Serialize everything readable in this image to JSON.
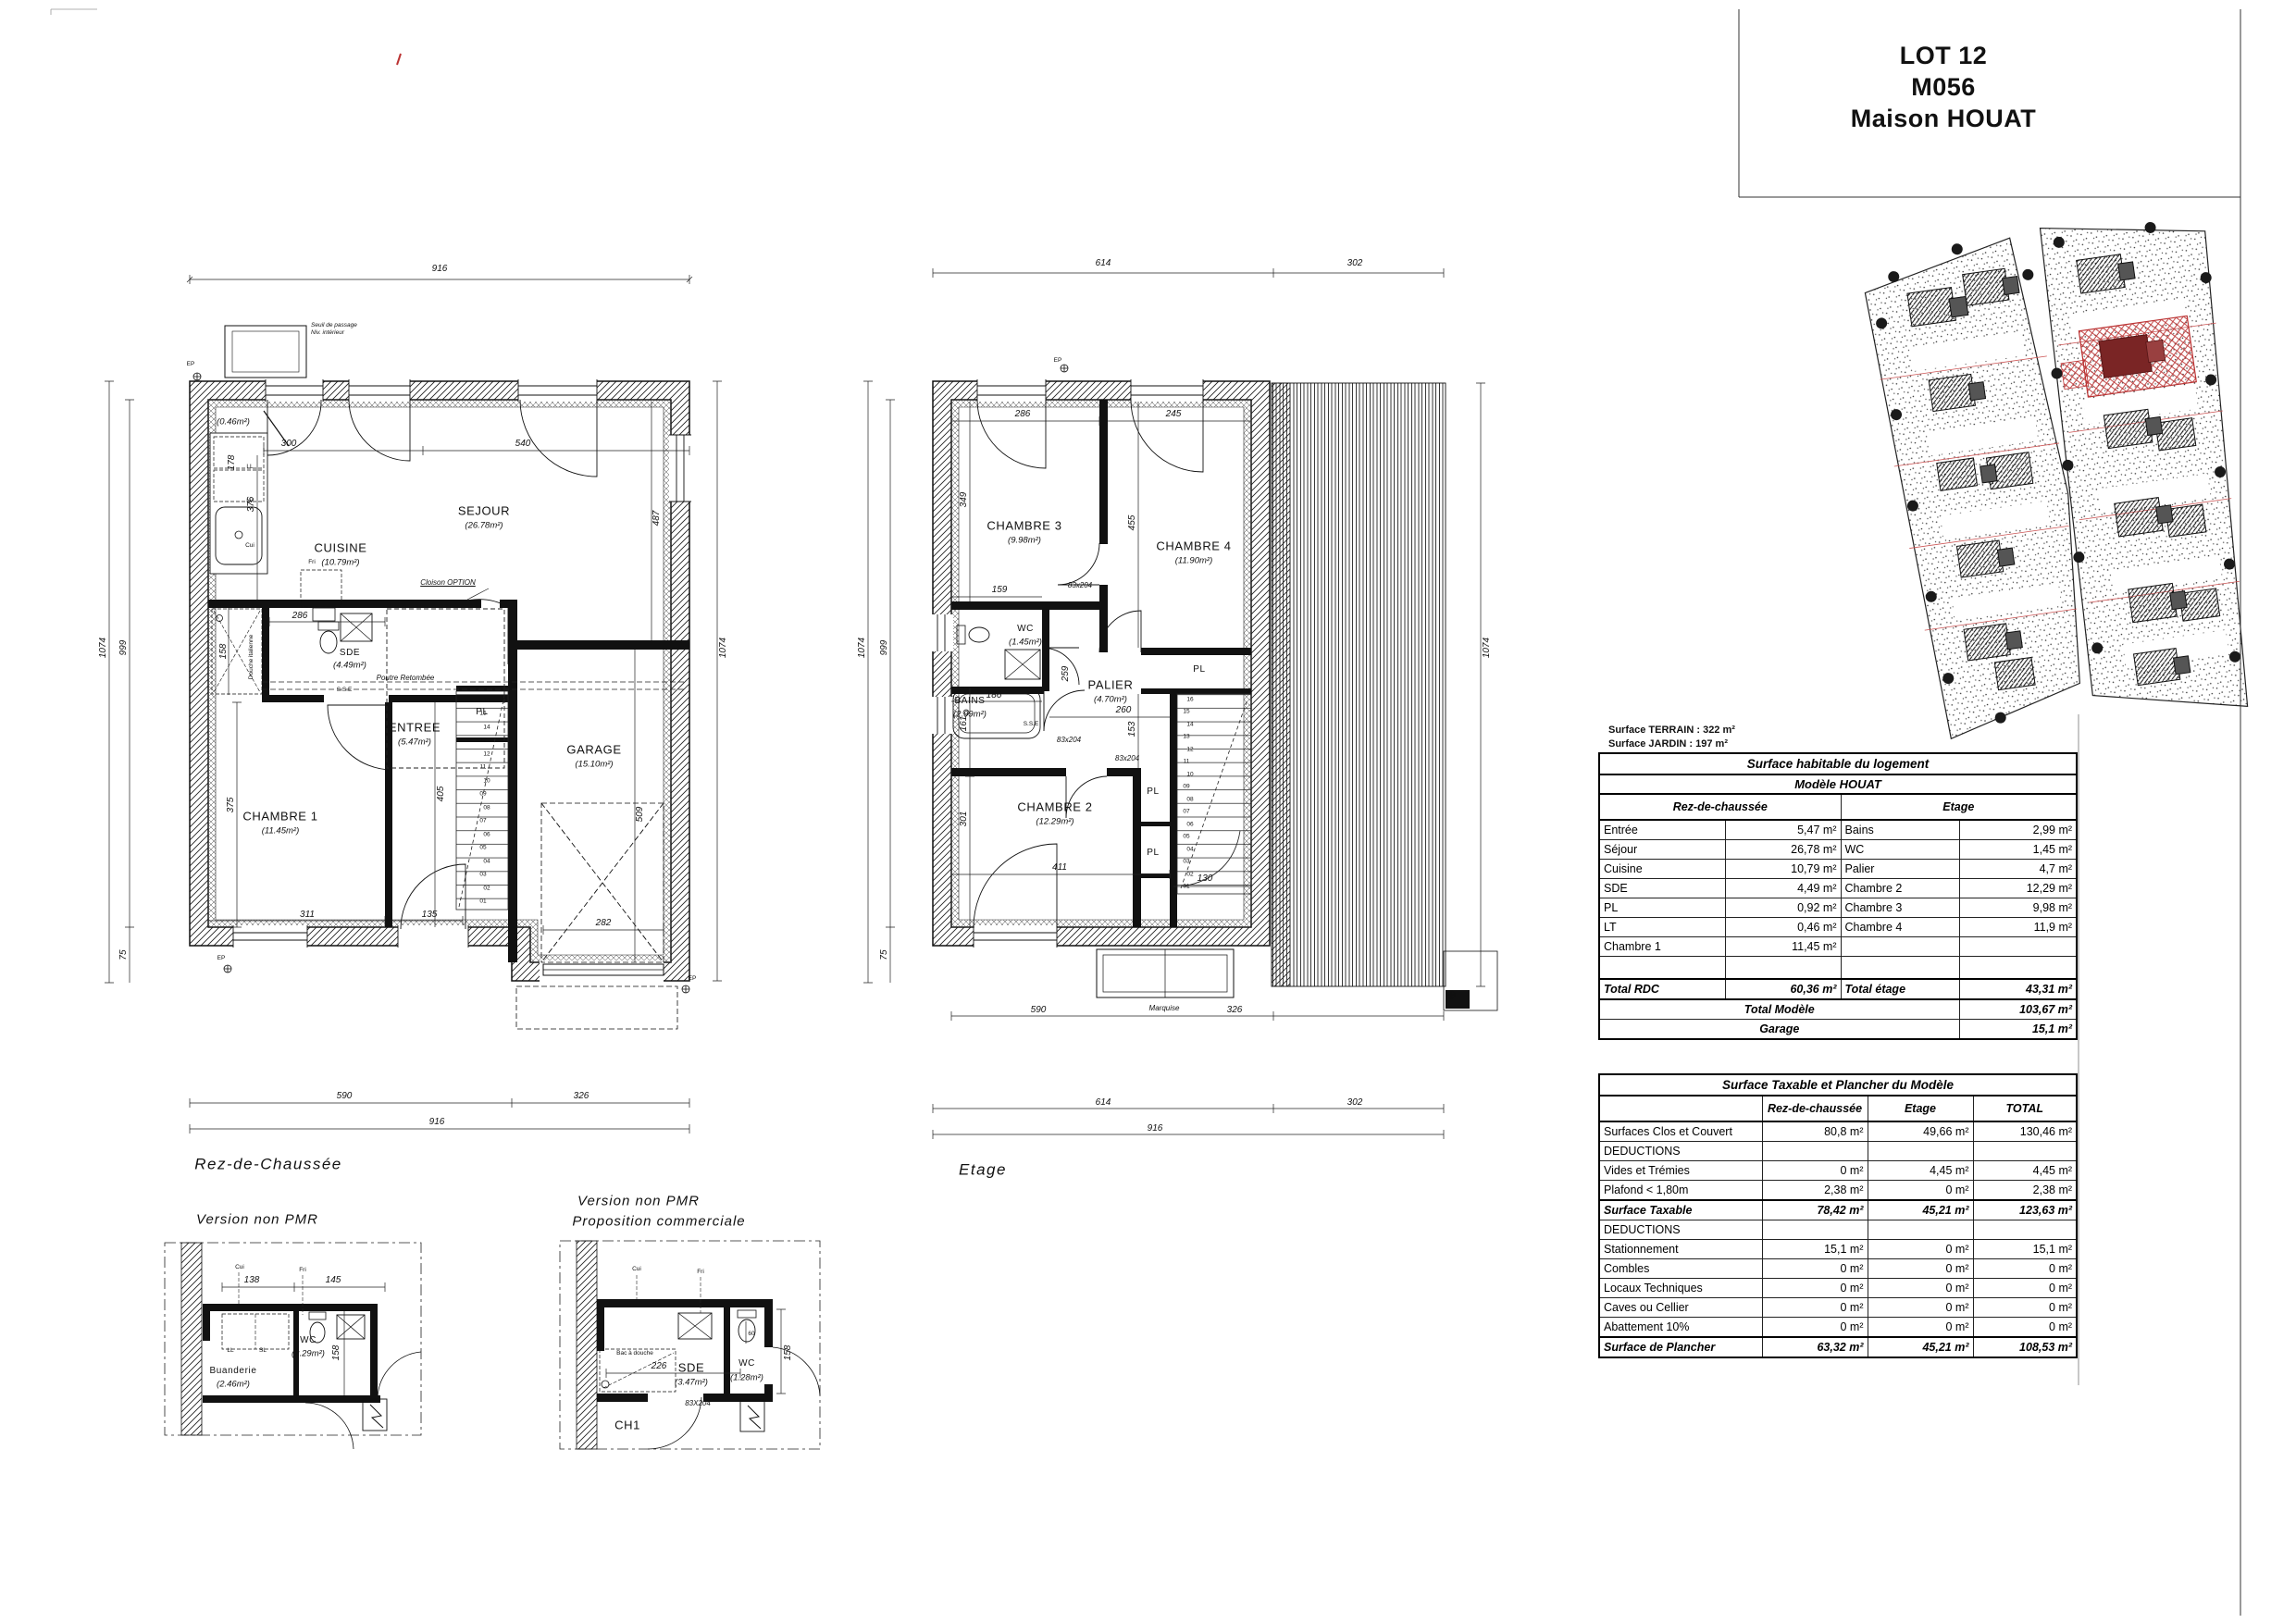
{
  "title_block": {
    "lot": "LOT 12",
    "code": "M056",
    "name": "Maison HOUAT"
  },
  "site_info": {
    "terrain": "Surface TERRAIN : 322 m²",
    "jardin": "Surface JARDIN :  197 m²"
  },
  "captions": {
    "rdc": "Rez-de-Chaussée",
    "etage": "Etage",
    "variant1": "Version non PMR",
    "variant2_line1": "Version non PMR",
    "variant2_line2": "Proposition commerciale"
  },
  "rdc": {
    "rooms": {
      "lt_area": "(0.46m²)",
      "cuisine_n": "CUISINE",
      "cuisine_a": "(10.79m²)",
      "sejour_n": "SEJOUR",
      "sejour_a": "(26.78m²)",
      "sde_n": "SDE",
      "sde_a": "(4.49m²)",
      "entree_n": "ENTREE",
      "entree_a": "(5.47m²)",
      "ch1_n": "CHAMBRE 1",
      "ch1_a": "(11.45m²)",
      "garage_n": "GARAGE",
      "garage_a": "(15.10m²)",
      "pl": "PL"
    },
    "labels": {
      "ll": "LL",
      "lv": "LV",
      "cui": "Cui",
      "fri": "Fri",
      "douche": "Douche italienne",
      "poutre": "Poutre Retombée",
      "sse": "S.S.E",
      "cloison": "Cloison OPTION",
      "ep": "EP",
      "seuil1": "Seuil de passage",
      "seuil2": "Niv. intérieur"
    },
    "dims": {
      "t916": "916",
      "i300": "300",
      "i540": "540",
      "i376": "376",
      "i178": "178",
      "i286": "286",
      "i375": "375",
      "i311": "311",
      "i135": "135",
      "i405": "405",
      "i282": "282",
      "i509": "509",
      "i487": "487",
      "i158": "158",
      "l1074": "1074",
      "l999": "999",
      "l75": "75",
      "r1074": "1074",
      "b590": "590",
      "b326": "326",
      "b916": "916"
    }
  },
  "etage": {
    "rooms": {
      "ch3_n": "CHAMBRE 3",
      "ch3_a": "(9.98m²)",
      "ch4_n": "CHAMBRE 4",
      "ch4_a": "(11.90m²)",
      "wc_n": "WC",
      "wc_a": "(1.45m²)",
      "palier_n": "PALIER",
      "palier_a": "(4.70m²)",
      "bains_n": "BAINS",
      "bains_a": "(2.99m²)",
      "ch2_n": "CHAMBRE 2",
      "ch2_a": "(12.29m²)",
      "pl": "PL"
    },
    "labels": {
      "marquise": "Marquise",
      "sse": "S.S.E",
      "door": "83x204",
      "ep": "EP"
    },
    "dims": {
      "t614": "614",
      "t302": "302",
      "i286": "286",
      "i245": "245",
      "i349": "349",
      "i455": "455",
      "i159": "159",
      "i186": "186",
      "i260": "260",
      "i301": "301",
      "i411": "411",
      "i153": "153",
      "i259": "259",
      "i130": "130",
      "i161": "161",
      "r1074": "1074",
      "l999": "999",
      "l1074": "1074",
      "l75": "75",
      "b590": "590",
      "b326": "326",
      "b614": "614",
      "b302": "302",
      "b916": "916"
    }
  },
  "detail1": {
    "rooms": {
      "buanderie_n": "Buanderie",
      "buanderie_a": "(2.46m²)",
      "wc_n": "WC",
      "wc_a": "(2.29m²)"
    },
    "dims": {
      "d138": "138",
      "d145": "145",
      "d158": "158"
    },
    "labels": {
      "cui": "Cui",
      "fri": "Fri",
      "ll": "LL",
      "sl": "SL"
    }
  },
  "detail2": {
    "rooms": {
      "sde_n": "SDE",
      "sde_a": "(3.47m²)",
      "wc_n": "WC",
      "wc_a": "(1.28m²)",
      "ch1": "CH1"
    },
    "dims": {
      "d226": "226",
      "d158": "158",
      "d60": "60"
    },
    "labels": {
      "bac": "Bac à douche",
      "door": "83X204",
      "cui": "Cui",
      "fri": "Fri"
    }
  },
  "stairs": {
    "steps": [
      "01",
      "02",
      "03",
      "04",
      "05",
      "06",
      "07",
      "08",
      "09",
      "10",
      "11",
      "12",
      "13",
      "14",
      "15",
      "16"
    ]
  },
  "tables": {
    "habitable": {
      "title": "Surface habitable du logement",
      "subtitle": "Modèle HOUAT",
      "col_left": "Rez-de-chaussée",
      "col_right": "Etage",
      "rows": [
        [
          "Entrée",
          "5,47 m²",
          "Bains",
          "2,99 m²"
        ],
        [
          "Séjour",
          "26,78 m²",
          "WC",
          "1,45 m²"
        ],
        [
          "Cuisine",
          "10,79 m²",
          "Palier",
          "4,7 m²"
        ],
        [
          "SDE",
          "4,49 m²",
          "Chambre 2",
          "12,29 m²"
        ],
        [
          "PL",
          "0,92 m²",
          "Chambre 3",
          "9,98 m²"
        ],
        [
          "LT",
          "0,46 m²",
          "Chambre 4",
          "11,9 m²"
        ],
        [
          "Chambre 1",
          "11,45 m²",
          "",
          ""
        ],
        [
          "",
          "",
          "",
          ""
        ]
      ],
      "total_row": [
        "Total RDC",
        "60,36 m²",
        "Total étage",
        "43,31 m²"
      ],
      "total_modele": {
        "label": "Total Modèle",
        "value": "103,67 m²"
      },
      "garage": {
        "label": "Garage",
        "value": "15,1 m²"
      }
    },
    "taxable": {
      "title": "Surface Taxable et Plancher du Modèle",
      "cols": [
        "Rez-de-chaussée",
        "Etage",
        "TOTAL"
      ],
      "rows": [
        {
          "l": "Surfaces Clos et Couvert",
          "v": [
            "80,8 m²",
            "49,66 m²",
            "130,46 m²"
          ],
          "bold": false
        },
        {
          "l": "DEDUCTIONS",
          "v": [
            "",
            "",
            ""
          ],
          "bold": false
        },
        {
          "l": "Vides et Trémies",
          "v": [
            "0 m²",
            "4,45 m²",
            "4,45 m²"
          ],
          "bold": false
        },
        {
          "l": "Plafond < 1,80m",
          "v": [
            "2,38 m²",
            "0 m²",
            "2,38 m²"
          ],
          "bold": false
        },
        {
          "l": "Surface Taxable",
          "v": [
            "78,42 m²",
            "45,21 m²",
            "123,63 m²"
          ],
          "bold": true
        },
        {
          "l": "DEDUCTIONS",
          "v": [
            "",
            "",
            ""
          ],
          "bold": false
        },
        {
          "l": "Stationnement",
          "v": [
            "15,1 m²",
            "0 m²",
            "15,1 m²"
          ],
          "bold": false
        },
        {
          "l": "Combles",
          "v": [
            "0 m²",
            "0 m²",
            "0 m²"
          ],
          "bold": false
        },
        {
          "l": "Locaux Techniques",
          "v": [
            "0 m²",
            "0 m²",
            "0 m²"
          ],
          "bold": false
        },
        {
          "l": "Caves ou Cellier",
          "v": [
            "0 m²",
            "0 m²",
            "0 m²"
          ],
          "bold": false
        },
        {
          "l": "Abattement 10%",
          "v": [
            "0 m²",
            "0 m²",
            "0 m²"
          ],
          "bold": false
        },
        {
          "l": "Surface de Plancher",
          "v": [
            "63,32 m²",
            "45,21 m²",
            "108,53 m²"
          ],
          "bold": true
        }
      ]
    }
  },
  "colors": {
    "accent_red": "#bb3333",
    "line": "#111111"
  }
}
